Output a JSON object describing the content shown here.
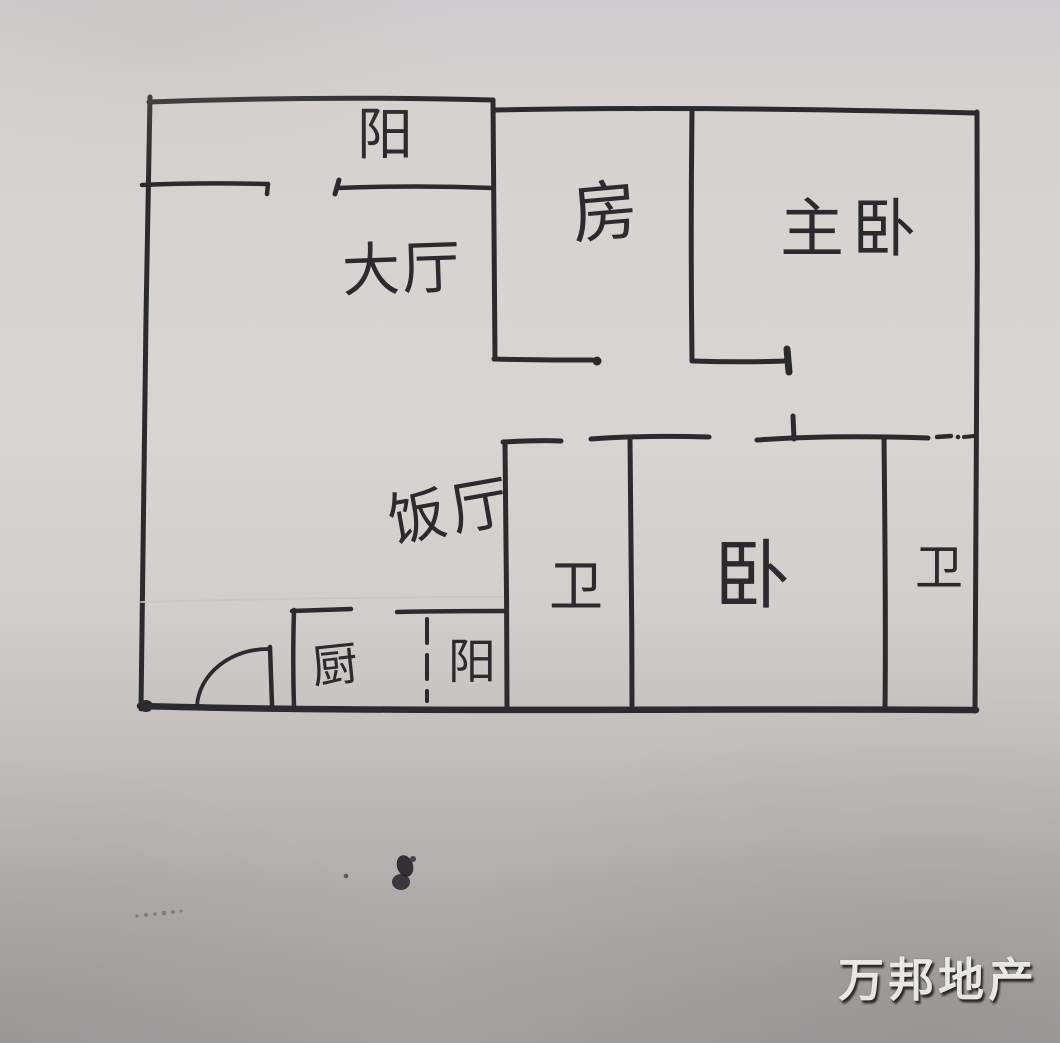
{
  "photo": {
    "description_labels": {
      "type": "hand-drawn-floor-plan"
    },
    "colors": {
      "ink": "#2b2a2e",
      "paper_top": "#d8d4d1",
      "paper_bottom": "#a3a0a0",
      "watermark_text": "#f7f5f2"
    }
  },
  "floorplan": {
    "labels": {
      "balcony_top": "阳",
      "living_room": "大厅",
      "room": "房",
      "master_bedroom": "主卧",
      "dining_room": "饭厅",
      "bath_left": "卫",
      "bedroom": "卧",
      "bath_right": "卫",
      "kitchen": "厨",
      "balcony_bottom": "阳"
    }
  },
  "watermark": {
    "text": "万邦地产"
  }
}
